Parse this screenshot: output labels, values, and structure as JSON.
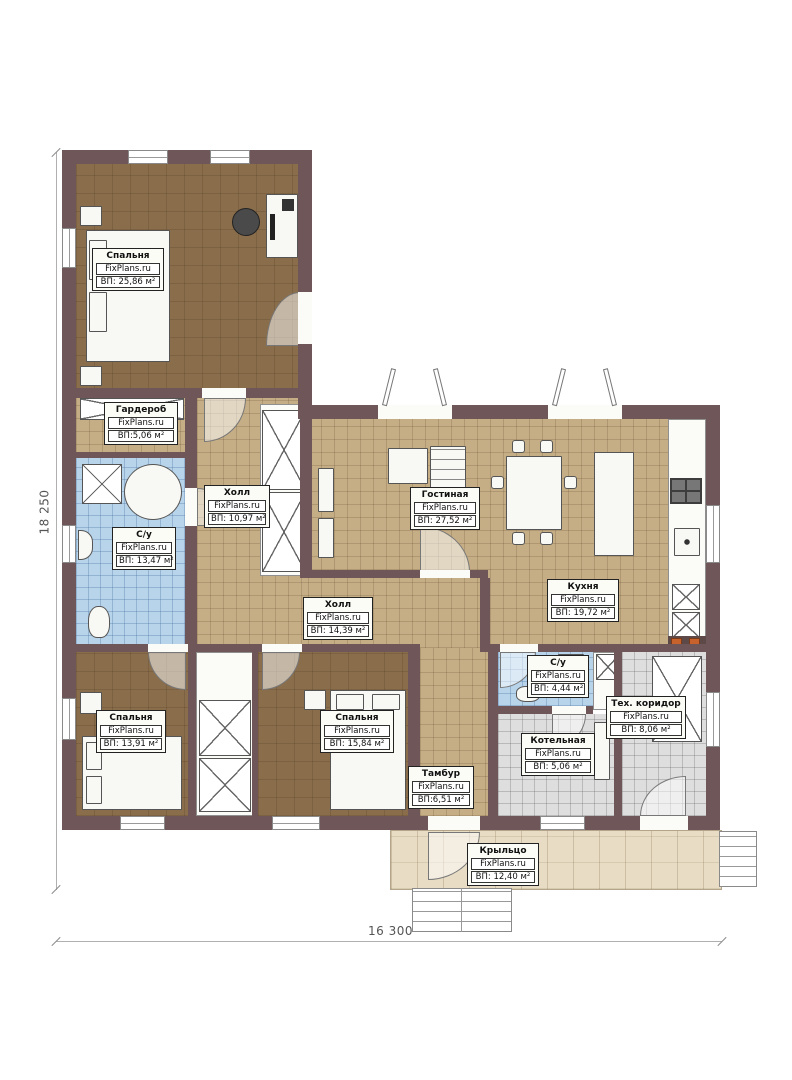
{
  "plan": {
    "brand": "FixPlans.ru",
    "dimensions": {
      "height_label": "18 250",
      "width_label": "16 300"
    },
    "rooms": [
      {
        "key": "bedroom-1",
        "name": "Спальня",
        "brand": "FixPlans.ru",
        "area": "ВП: 25,86 м²"
      },
      {
        "key": "wardrobe",
        "name": "Гардероб",
        "brand": "FixPlans.ru",
        "area": "ВП:5,06 м²"
      },
      {
        "key": "hall-1",
        "name": "Холл",
        "brand": "FixPlans.ru",
        "area": "ВП: 10,97 м²"
      },
      {
        "key": "bathroom-1",
        "name": "С/у",
        "brand": "FixPlans.ru",
        "area": "ВП: 13,47 м²"
      },
      {
        "key": "living-room",
        "name": "Гостиная",
        "brand": "FixPlans.ru",
        "area": "ВП: 27,52 м²"
      },
      {
        "key": "kitchen",
        "name": "Кухня",
        "brand": "FixPlans.ru",
        "area": "ВП: 19,72 м²"
      },
      {
        "key": "hall-2",
        "name": "Холл",
        "brand": "FixPlans.ru",
        "area": "ВП: 14,39 м²"
      },
      {
        "key": "bedroom-2",
        "name": "Спальня",
        "brand": "FixPlans.ru",
        "area": "ВП: 13,91 м²"
      },
      {
        "key": "bedroom-3",
        "name": "Спальня",
        "brand": "FixPlans.ru",
        "area": "ВП: 15,84 м²"
      },
      {
        "key": "bathroom-2",
        "name": "С/у",
        "brand": "FixPlans.ru",
        "area": "ВП: 4,44 м²"
      },
      {
        "key": "tech-corridor",
        "name": "Тех. коридор",
        "brand": "FixPlans.ru",
        "area": "ВП: 8,06 м²"
      },
      {
        "key": "boiler-room",
        "name": "Котельная",
        "brand": "FixPlans.ru",
        "area": "ВП: 5,06 м²"
      },
      {
        "key": "vestibule",
        "name": "Тамбур",
        "brand": "FixPlans.ru",
        "area": "ВП:6,51 м²"
      },
      {
        "key": "porch",
        "name": "Крыльцо",
        "brand": "FixPlans.ru",
        "area": "ВП: 12,40 м²"
      }
    ],
    "colors": {
      "wall": "#6e5659",
      "floor_wood": "#8a6e4b",
      "floor_tan": "#c5ae86",
      "floor_tile_blue": "#b8d4ea",
      "floor_tile_gray": "#dedede",
      "floor_porch": "#e8ddc4",
      "accent_orange": "#c8622d"
    }
  }
}
